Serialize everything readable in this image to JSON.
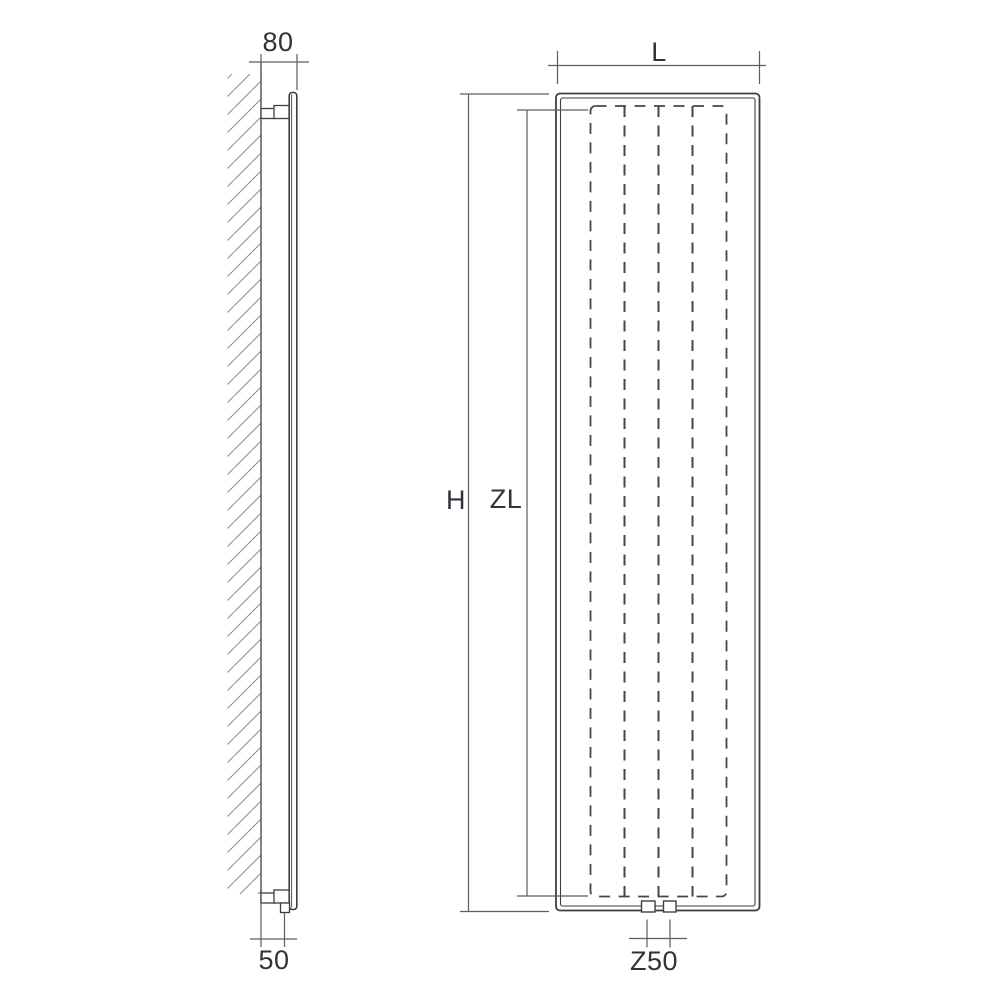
{
  "diagram": {
    "type": "technical-drawing",
    "subject": "vertical panel radiator — side and front dimension views",
    "views": {
      "side": "wall-mounted side view",
      "front": "front view"
    },
    "dimensions": {
      "top_bracket_depth": "80",
      "bottom_bracket_depth": "50",
      "width": "L",
      "height": "H",
      "inner_height": "ZL",
      "connection_spacing": "Z50"
    },
    "colors": {
      "background": "#ffffff",
      "outline": "#3d3d46",
      "dimension_line": "#5c5c64",
      "dashed_line": "#45454e",
      "hatch": "#8f8f96",
      "text": "#32323a"
    }
  }
}
